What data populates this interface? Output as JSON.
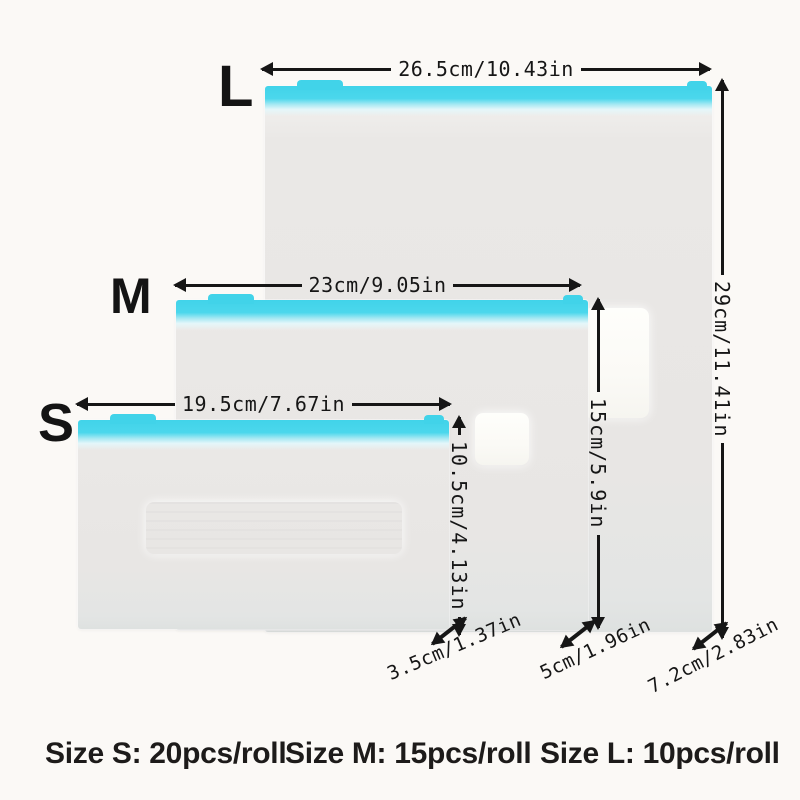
{
  "accent_color": "#41d3e9",
  "sizes": {
    "l": {
      "letter": "L",
      "width_dim": "26.5cm/10.43in",
      "height_dim": "29cm/11.41in",
      "bottom_dim": "7.2cm/2.83in",
      "pcs_label": "Size L: 10pcs/roll"
    },
    "m": {
      "letter": "M",
      "width_dim": "23cm/9.05in",
      "height_dim": "15cm/5.9in",
      "bottom_dim": "5cm/1.96in",
      "pcs_label": "Size M: 15pcs/roll"
    },
    "s": {
      "letter": "S",
      "width_dim": "19.5cm/7.67in",
      "height_dim": "10.5cm/4.13in",
      "bottom_dim": "3.5cm/1.37in",
      "pcs_label": "Size S: 20pcs/roll"
    }
  }
}
